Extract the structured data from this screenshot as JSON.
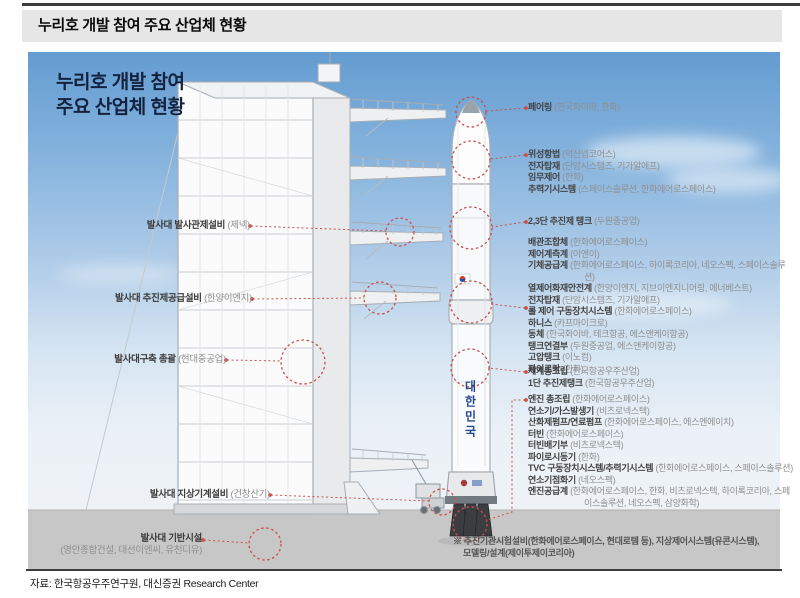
{
  "header": {
    "title": "누리호 개발 참여 주요 산업체 현황"
  },
  "infographic": {
    "title_line1": "누리호 개발 참여",
    "title_line2": "주요 산업체 현황",
    "rocket_side_text": "대한민국"
  },
  "left_labels": [
    {
      "name": "발사대 발사관제설비",
      "company": "(제넥)"
    },
    {
      "name": "발사대 추진제공급설비",
      "company": "(한양이엔지)"
    },
    {
      "name": "발사대구축 총괄",
      "company": "(현대중공업)"
    },
    {
      "name": "발사대 지상기계설비",
      "company": "(건창산기)"
    },
    {
      "name": "발사대 기반시설",
      "company": "(영안종합건설, 대선이엔씨, 유천디유)"
    }
  ],
  "right_groups": [
    {
      "items": [
        {
          "name": "페어링",
          "company": "(한국화이바, 한화)"
        }
      ]
    },
    {
      "items": [
        {
          "name": "위성항법",
          "company": "(덕산넵코어스)"
        },
        {
          "name": "전자탑재",
          "company": "(단암시스템즈, 기가알에프)"
        },
        {
          "name": "임무제어",
          "company": "(한화)"
        },
        {
          "name": "추력기시스템",
          "company": "(스페이스솔루션, 한화에어로스페이스)"
        }
      ]
    },
    {
      "items": [
        {
          "name": "2,3단 추진제 탱크",
          "company": "(두원중공업)"
        }
      ]
    },
    {
      "items": [
        {
          "name": "배관조합체",
          "company": "(한화에어로스페이스)"
        },
        {
          "name": "제어계측계",
          "company": "(이앤이)"
        },
        {
          "name": "기체공급계",
          "company": "(한화에어로스페이스, 하이록코리아, 네오스펙, 스페이스솔루션)"
        },
        {
          "name": "열제어화재안전계",
          "company": "(한양이엔지, 지브이엔지니어링, 에너베스트)"
        },
        {
          "name": "전자탑재",
          "company": "(단암시스템즈, 기가알에프)"
        },
        {
          "name": "롤 제어 구동장치시스템",
          "company": "(한화에어로스페이스)"
        },
        {
          "name": "하니스",
          "company": "(카프마이크로)"
        },
        {
          "name": "동체",
          "company": "(한국화이바, 테크항공, 에스앤케이항공)"
        },
        {
          "name": "탱크연결부",
          "company": "(두원중공업, 에스앤케이항공)"
        },
        {
          "name": "고압탱크",
          "company": "(이노컴)"
        },
        {
          "name": "파이로락",
          "company": "(한화)"
        }
      ]
    },
    {
      "items": [
        {
          "name": "체계총조립",
          "company": "(한국항공우주산업)"
        },
        {
          "name": "1단 추진제탱크",
          "company": "(한국항공우주산업)"
        }
      ]
    },
    {
      "items": [
        {
          "name": "엔진 총조립",
          "company": "(한화에어로스페이스)"
        },
        {
          "name": "연소기/가스발생기",
          "company": "(비츠로넥스텍)"
        },
        {
          "name": "산화제펌프/연료펌프",
          "company": "(한화에어로스페이스, 에스엔에이치)"
        },
        {
          "name": "터빈",
          "company": "(한화에어로스페이스)"
        },
        {
          "name": "터빈배기부",
          "company": "(비츠로넥스텍)"
        },
        {
          "name": "파이로시동기",
          "company": "(한화)"
        },
        {
          "name": "TVC 구동장치시스템/추력기시스템",
          "company": "(한화에어로스페이스, 스페이스솔루션)"
        },
        {
          "name": "연소기점화기",
          "company": "(네오스펙)"
        },
        {
          "name": "엔진공급계",
          "company": "(한화에어로스페이스, 한화, 비츠로넥스텍, 하이록코리아, 스페이스솔루션, 네오스펙, 삼양화학)"
        }
      ]
    }
  ],
  "footnote": {
    "line1": "※ 추진기관시험설비(한화에어로스페이스, 현대로템 등), 지상제어시스템(유콘시스템),",
    "line2": "모델링/설계(제이투제이코리아)"
  },
  "source": "자료: 한국항공우주연구원, 대신증권 Research Center",
  "colors": {
    "accent_red": "#c9504a",
    "sky_top": "#649cd1",
    "ground_gray": "#c7c7c7",
    "title_bar_bg": "#e6e6e6",
    "rocket_text_blue": "#27498f"
  }
}
